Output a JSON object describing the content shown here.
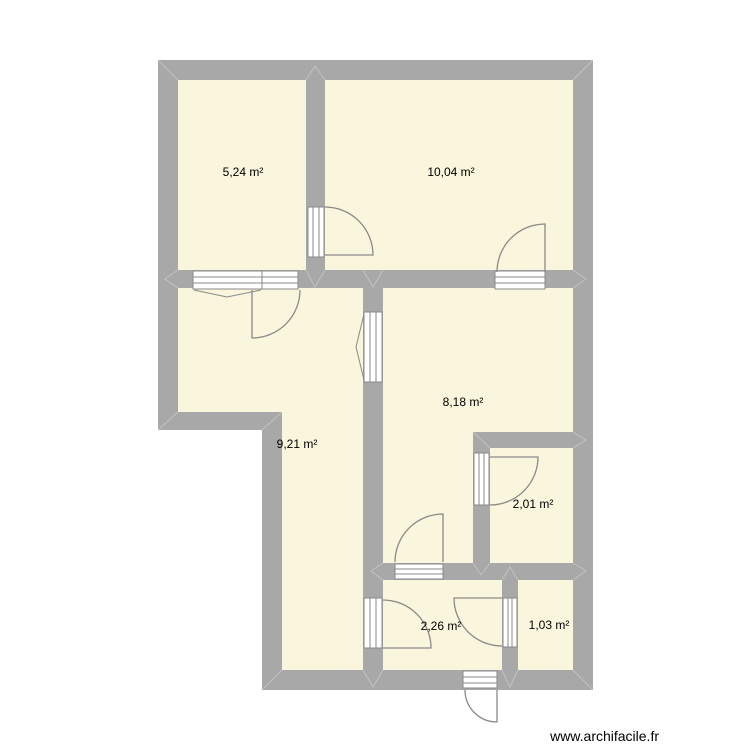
{
  "watermark": {
    "text": "www.archifacile.fr"
  },
  "units": "m²",
  "colors": {
    "background": "#ffffff",
    "wall": "#a8a8a8",
    "room_fill": "#faf5dd",
    "opening_stroke": "#8a8a8a",
    "opening_fill": "#ffffff",
    "joint_seam": "#c2c2c2",
    "label_text": "#000000"
  },
  "rooms": [
    {
      "id": "room-524",
      "label": "5,24 m²",
      "area_m2": 5.24
    },
    {
      "id": "room-1004",
      "label": "10,04 m²",
      "area_m2": 10.04
    },
    {
      "id": "room-921",
      "label": "9,21 m²",
      "area_m2": 9.21
    },
    {
      "id": "room-818",
      "label": "8,18 m²",
      "area_m2": 8.18
    },
    {
      "id": "room-201",
      "label": "2,01 m²",
      "area_m2": 2.01
    },
    {
      "id": "room-226",
      "label": "2,26 m²",
      "area_m2": 2.26
    },
    {
      "id": "room-103",
      "label": "1,03 m²",
      "area_m2": 1.03
    }
  ],
  "openings": {
    "doors": [
      {
        "id": "door-524-1004",
        "between": [
          "5,24 m²",
          "10,04 m²"
        ]
      },
      {
        "id": "door-524-921",
        "between": [
          "5,24 m²",
          "9,21 m²"
        ]
      },
      {
        "id": "door-1004-818",
        "between": [
          "10,04 m²",
          "8,18 m²"
        ]
      },
      {
        "id": "door-818-201",
        "between": [
          "8,18 m²",
          "2,01 m²"
        ]
      },
      {
        "id": "door-818-226",
        "between": [
          "8,18 m²",
          "2,26 m²"
        ]
      },
      {
        "id": "door-921-226",
        "between": [
          "9,21 m²",
          "2,26 m²"
        ]
      },
      {
        "id": "door-226-103",
        "between": [
          "2,26 m²",
          "1,03 m²"
        ]
      },
      {
        "id": "door-entrance",
        "between": [
          "2,26 m²",
          "exterior"
        ]
      }
    ],
    "windows": [
      {
        "id": "window-524-921",
        "between": [
          "5,24 m²",
          "9,21 m²"
        ]
      },
      {
        "id": "window-921-818",
        "between": [
          "9,21 m²",
          "8,18 m²"
        ]
      }
    ]
  }
}
